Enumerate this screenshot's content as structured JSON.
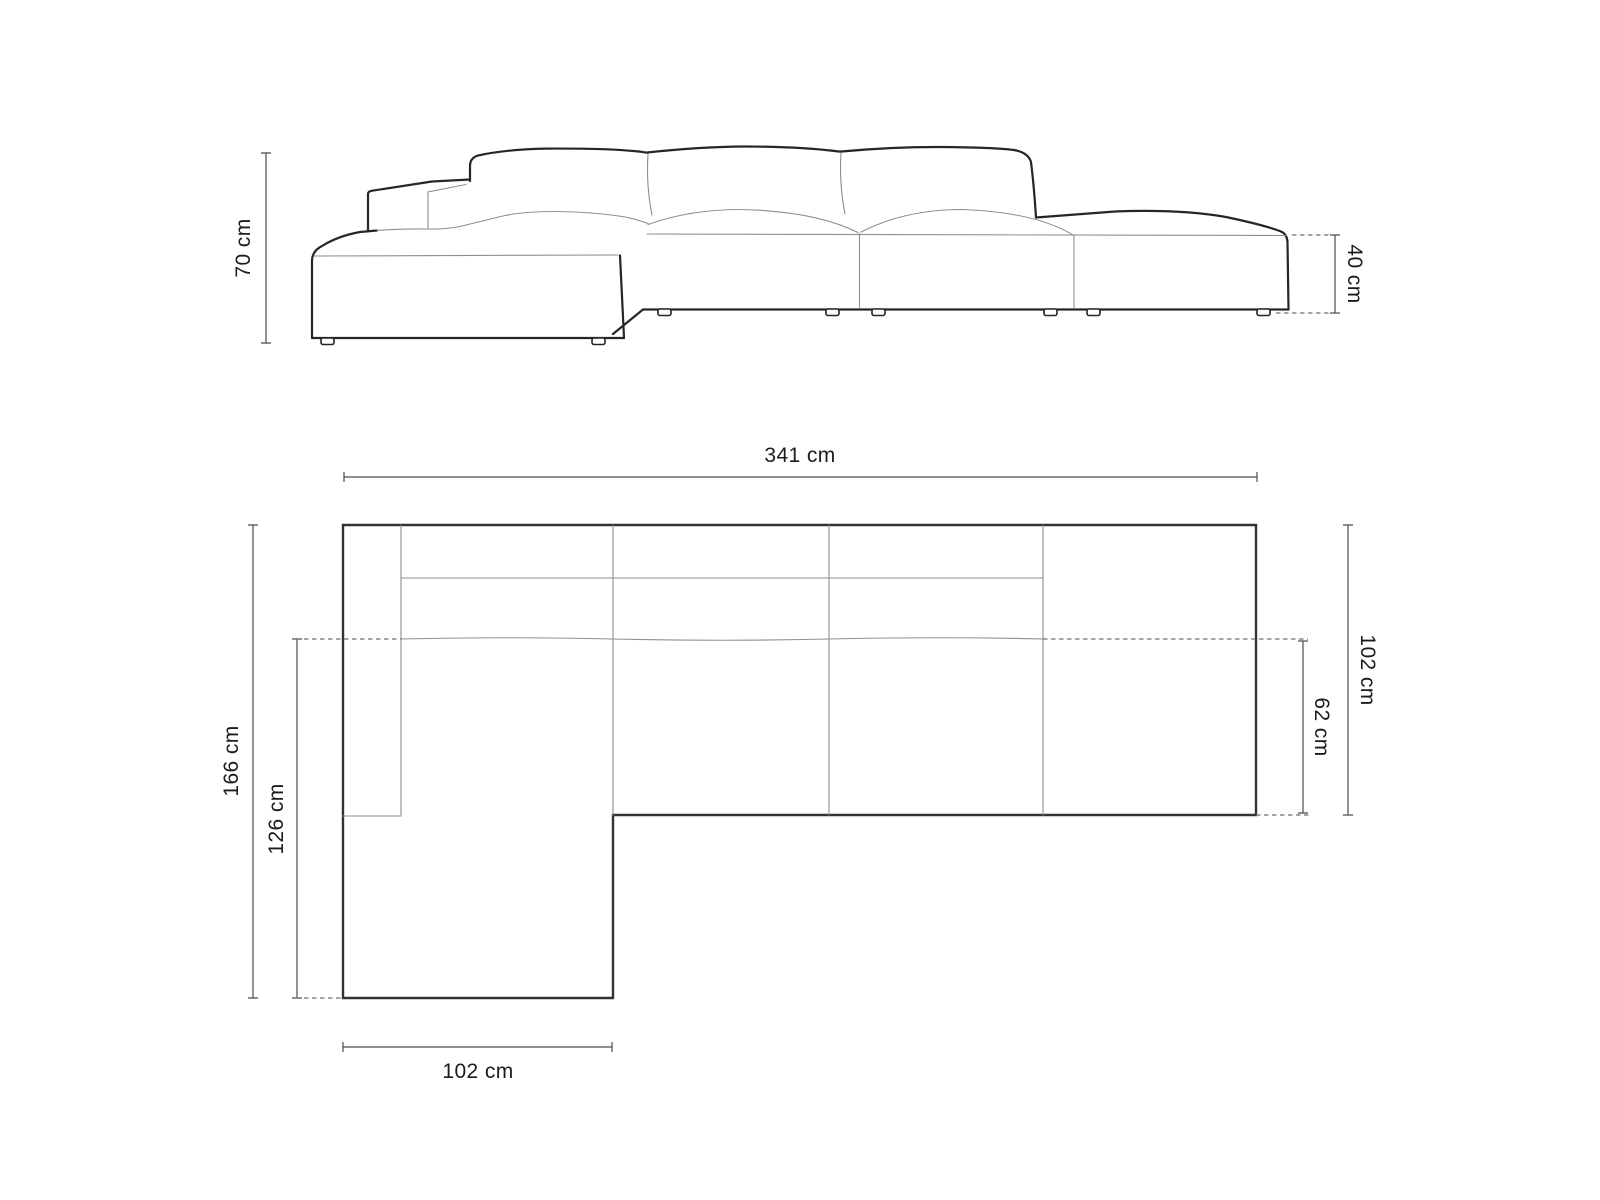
{
  "diagram": {
    "unit": "cm",
    "side_view": {
      "name": "side elevation",
      "dimensions": {
        "height": "70 cm",
        "seat_height": "40 cm"
      }
    },
    "top_view": {
      "name": "plan view",
      "dimensions": {
        "total_width": "341 cm",
        "total_depth": "166 cm",
        "chaise_depth": "126 cm",
        "body_depth": "102 cm",
        "seat_depth": "62 cm",
        "chaise_width": "102 cm"
      }
    },
    "colors": {
      "background": "#ffffff",
      "outline": "#262626",
      "plan_outline": "#333333",
      "thin_line": "#8e8e8e",
      "dimension_line": "#4c4c4c",
      "dashed_line": "#707070",
      "text": "#1c1c1c"
    }
  }
}
